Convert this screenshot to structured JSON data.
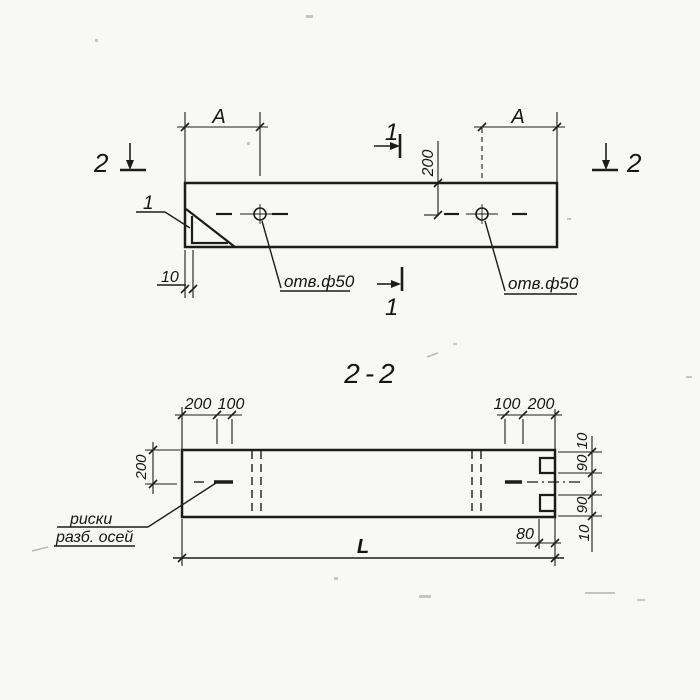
{
  "colors": {
    "background": "#f8f8f5",
    "ink": "#1c1c1c"
  },
  "plan_view": {
    "section_mark_left": "2",
    "section_mark_right": "2",
    "section_mark_top": "1",
    "section_mark_bottom": "1",
    "dim_a_left": "A",
    "dim_a_right": "A",
    "dim_depth_200": "200",
    "dim_edge_10": "10",
    "detail_callout": "1",
    "hole_label_left": "отв.ф50",
    "hole_label_right": "отв.ф50"
  },
  "section_view": {
    "title": "2-2",
    "dim_top_left_200": "200",
    "dim_top_left_100": "100",
    "dim_top_right_100": "100",
    "dim_top_right_200": "200",
    "dim_left_200": "200",
    "dim_right_10_top": "10",
    "dim_right_90_top": "90",
    "dim_right_90_bottom": "90",
    "dim_right_10_bottom": "10",
    "dim_80": "80",
    "dim_length": "L",
    "axis_note_line1": "риски",
    "axis_note_line2": "разб. осей"
  }
}
